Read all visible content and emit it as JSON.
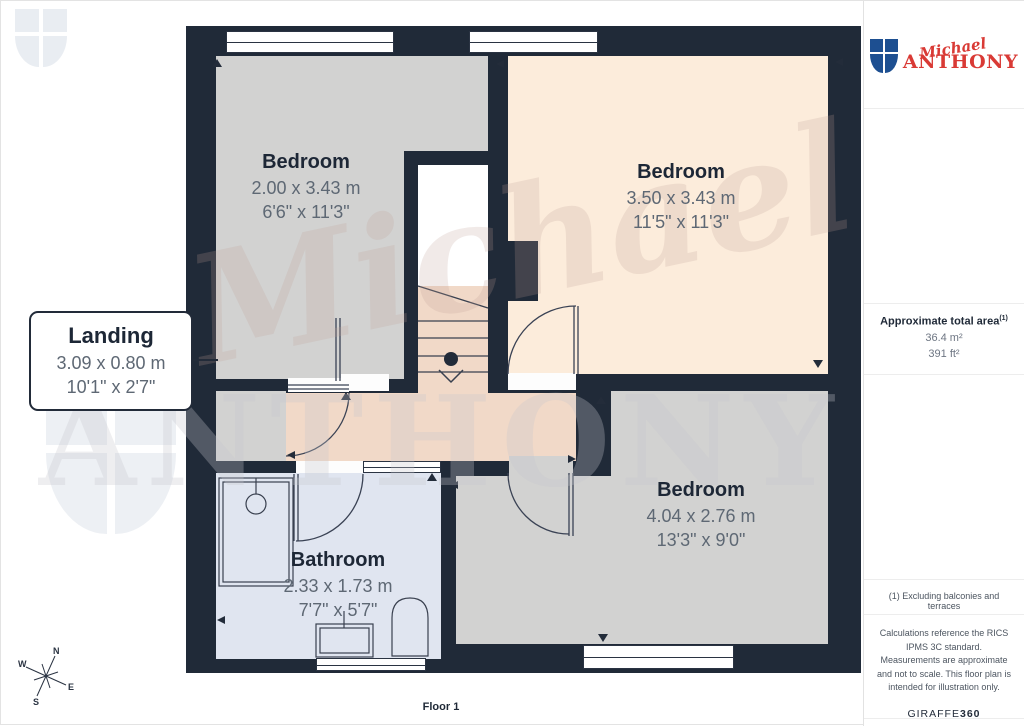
{
  "branding": {
    "logo_script": "Michael",
    "logo_serif": "ANTHONY"
  },
  "colors": {
    "wall": "#202a38",
    "bedroom_gray": "#d2d2d1",
    "bedroom_peach": "#fcecdb",
    "landing_tan": "#f1d9c8",
    "bathroom_blue": "#e0e5f0",
    "accent_red": "#d93a35",
    "shield_blue": "#1d4f91",
    "text_dark": "#1d2736",
    "text_dim": "#5e6874"
  },
  "rooms": [
    {
      "name": "Bedroom",
      "metric": "2.00 x 3.43 m",
      "imperial": "6'6\" x 11'3\""
    },
    {
      "name": "Bedroom",
      "metric": "3.50 x 3.43 m",
      "imperial": "11'5\" x 11'3\""
    },
    {
      "name": "Bedroom",
      "metric": "4.04 x 2.76 m",
      "imperial": "13'3\" x 9'0\""
    },
    {
      "name": "Bathroom",
      "metric": "2.33 x 1.73 m",
      "imperial": "7'7\" x 5'7\""
    },
    {
      "name": "Landing",
      "metric": "3.09 x 0.80 m",
      "imperial": "10'1\" x 2'7\""
    }
  ],
  "floor": {
    "label": "Floor 1"
  },
  "compass": {
    "n": "N",
    "e": "E",
    "s": "S",
    "w": "W"
  },
  "sidebar": {
    "area": {
      "title": "Approximate total area",
      "sup": "(1)",
      "metric": "36.4 m²",
      "imperial": "391 ft²"
    },
    "footnote": "(1) Excluding balconies and terraces",
    "disclaimer": "Calculations reference the RICS IPMS 3C standard. Measurements are approximate and not to scale. This floor plan is intended for illustration only.",
    "brand_name": "GIRAFFE",
    "brand_number": "360"
  }
}
